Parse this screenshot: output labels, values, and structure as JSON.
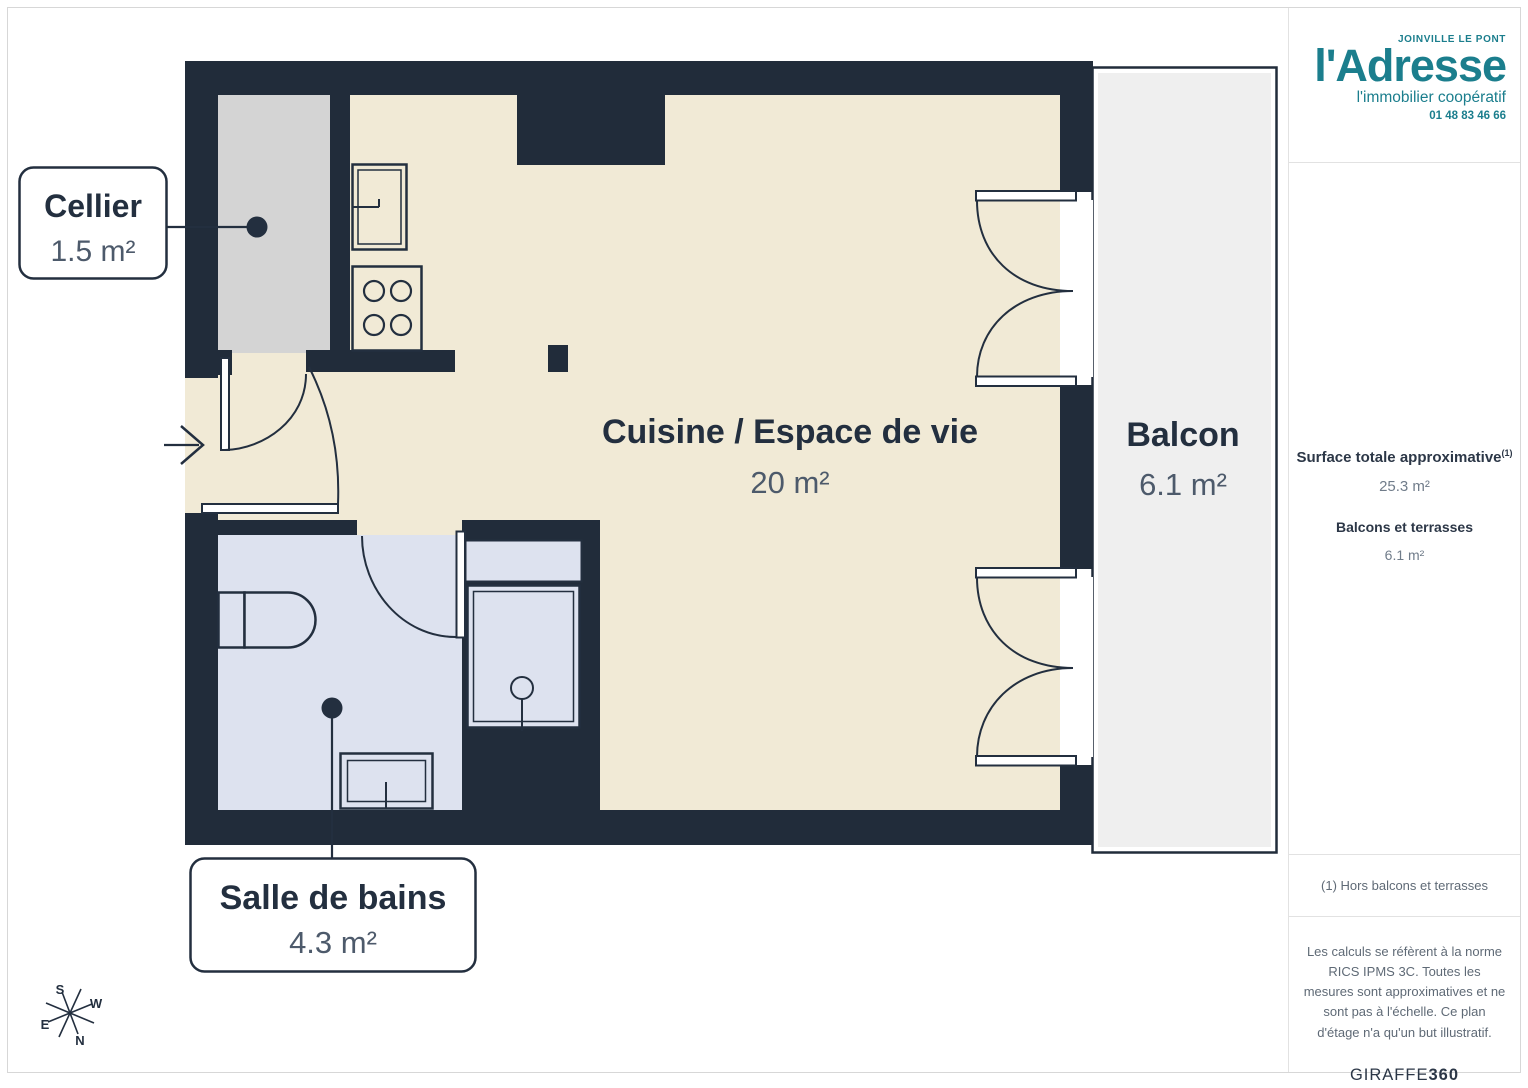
{
  "plan": {
    "rooms": {
      "cellier": {
        "name": "Cellier",
        "area": "1.5 m²"
      },
      "cuisine": {
        "name": "Cuisine / Espace de vie",
        "area": "20 m²"
      },
      "balcon": {
        "name": "Balcon",
        "area": "6.1 m²"
      },
      "salle_de_bains": {
        "name": "Salle de bains",
        "area": "4.3 m²"
      }
    },
    "compass": {
      "n": "N",
      "s": "S",
      "e": "E",
      "w": "W"
    }
  },
  "sidebar": {
    "logo": {
      "city": "JOINVILLE LE PONT",
      "brand": "l'Adresse",
      "tagline": "l'immobilier coopératif",
      "phone": "01 48 83 46 66"
    },
    "surface": {
      "total_label": "Surface totale approximative",
      "total_note": "(1)",
      "total_value": "25.3 m²",
      "balcony_label": "Balcons et terrasses",
      "balcony_value": "6.1 m²"
    },
    "footnote": "(1) Hors balcons et terrasses",
    "legal": "Les calculs se réfèrent à la norme RICS IPMS 3C. Toutes les mesures sont approximatives et ne sont pas à l'échelle. Ce plan d'étage n'a qu'un but illustratif.",
    "watermark": {
      "giraffe": "GIRAFFE",
      "n360": "360"
    }
  },
  "colors": {
    "brand_teal": "#1b7e8d",
    "wall": "#212c3a",
    "floor_cream": "#f1ead6",
    "floor_cellier": "#d4d4d4",
    "floor_bath": "#dde2ef",
    "floor_balcony": "#efefef",
    "text_primary": "#232f3f",
    "text_secondary": "#4d5a6b",
    "sidebar_text": "#5f6a76"
  }
}
